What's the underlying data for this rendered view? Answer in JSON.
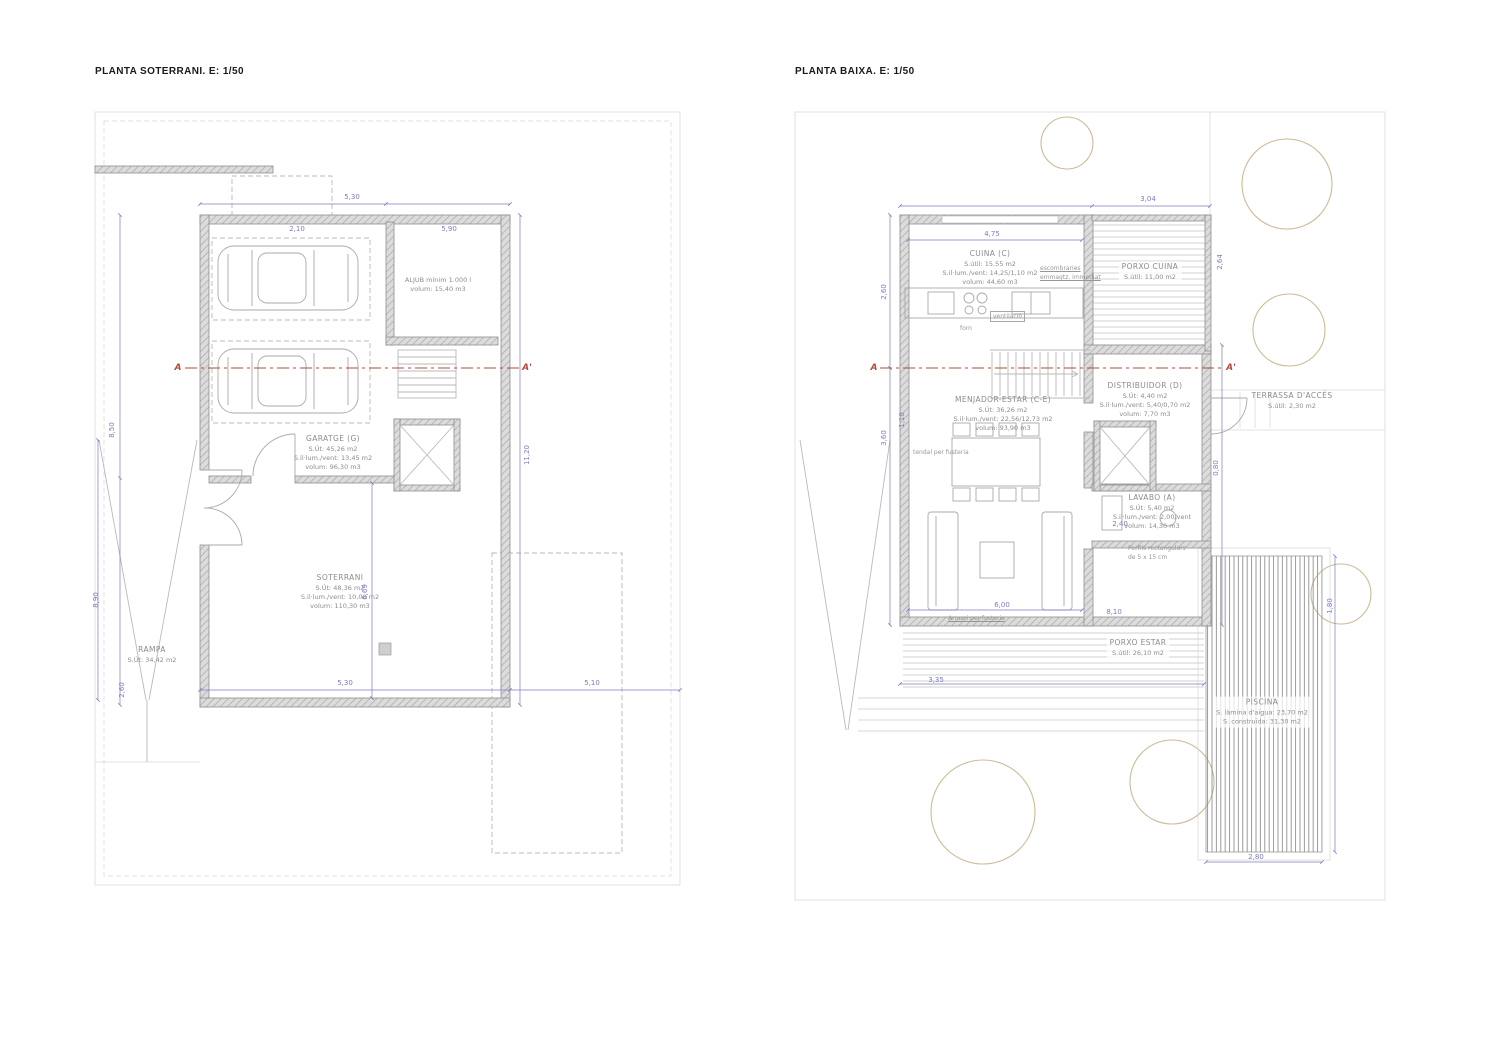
{
  "colors": {
    "paper": "#ffffff",
    "line": "#b9b9b9",
    "line_light": "#d9d9d9",
    "wall_edge": "#8f8f8f",
    "wall_fill": "#dcdcdc",
    "wall_hatch": "#a8a8a8",
    "furniture": "#a9a9a9",
    "dimension": "#7b7bc4",
    "section": "#b5483a",
    "tree": "#cdbb95",
    "label": "#8c8c8c",
    "title": "#1a1a1a"
  },
  "left_plan": {
    "title": "PLANTA SOTERRANI. E: 1/50",
    "section_marks": {
      "start": "A",
      "end": "A'"
    },
    "rooms": {
      "aljub": {
        "lines": [
          "ALJUB mínim 1.000 l",
          "volum: 15,40 m3"
        ]
      },
      "garatge": {
        "lines": [
          "GARATGE (G)",
          "S.Út: 45,26 m2",
          "S.il·lum./vent: 13,45 m2",
          "volum: 96,30 m3"
        ]
      },
      "soterrani": {
        "lines": [
          "SOTERRANI",
          "S.Út: 48,36 m2",
          "S.il·lum./vent: 10,00 m2",
          "volum: 110,30 m3"
        ]
      },
      "rampa": {
        "lines": [
          "RAMPA",
          "S.Út: 34,42 m2"
        ]
      }
    },
    "dims": [
      {
        "t": "5,30",
        "x": 352,
        "y": 197
      },
      {
        "t": "2,10",
        "x": 297,
        "y": 229
      },
      {
        "t": "5,90",
        "x": 449,
        "y": 229
      },
      {
        "t": "8,50",
        "x": 112,
        "y": 430,
        "v": 1
      },
      {
        "t": "8,90",
        "x": 96,
        "y": 600,
        "v": 1
      },
      {
        "t": "11,20",
        "x": 527,
        "y": 455,
        "v": 1
      },
      {
        "t": "6,69",
        "x": 365,
        "y": 592,
        "v": 1
      },
      {
        "t": "2,60",
        "x": 122,
        "y": 690,
        "v": 1
      },
      {
        "t": "5,30",
        "x": 345,
        "y": 683
      },
      {
        "t": "5,10",
        "x": 592,
        "y": 683
      }
    ]
  },
  "right_plan": {
    "title": "PLANTA BAIXA. E: 1/50",
    "section_marks": {
      "start": "A",
      "end": "A'"
    },
    "rooms": {
      "cuina": {
        "lines": [
          "CUINA (C)",
          "S.útil: 15,55 m2",
          "S.il·lum./vent: 14,25/1,10 m2",
          "volum: 44,60 m3"
        ]
      },
      "porxo_cuina": {
        "lines": [
          "PORXO CUINA",
          "S.útil: 11,00 m2"
        ]
      },
      "menjador": {
        "lines": [
          "MENJADOR-ESTAR (C-E)",
          "S.Út: 36,26 m2",
          "S.il·lum./vent: 22,56/12,73 m2",
          "volum: 93,90 m3"
        ]
      },
      "distribuidor": {
        "lines": [
          "DISTRIBUIDOR (D)",
          "S.Út: 4,40 m2",
          "S.il·lum./vent: 5,40/0,70 m2",
          "volum: 7,70 m3"
        ]
      },
      "lavabo": {
        "lines": [
          "LAVABO (A)",
          "S.Út: 5,40 m2",
          "S.il·lum./vent: 2,00/vent",
          "volum: 14,30 m3"
        ]
      },
      "terrassa": {
        "lines": [
          "TERRASSA D'ACCÉS",
          "S.útil: 2,30 m2"
        ]
      },
      "porxo_estar": {
        "lines": [
          "PORXO ESTAR",
          "S.útil: 26,10 m2"
        ]
      },
      "piscina": {
        "lines": [
          "PISCINA",
          "S. làmina d'aigua: 23,70 m2",
          "S. construïda: 31,30 m2"
        ]
      }
    },
    "notes": {
      "escombraries": [
        "escombraries",
        "emmagtz. immediat"
      ],
      "ventilacio": "ventilació",
      "forn": "forn",
      "tendal": "tendal per fusteria",
      "armari": "Armari per fusteria",
      "perfils": [
        "Perfils rectangulars",
        "de 5 x 15 cm"
      ]
    },
    "dims": [
      {
        "t": "3,04",
        "x": 1148,
        "y": 199
      },
      {
        "t": "4,75",
        "x": 992,
        "y": 234
      },
      {
        "t": "2,64",
        "x": 1220,
        "y": 262,
        "v": 1
      },
      {
        "t": "2,60",
        "x": 884,
        "y": 292,
        "v": 1
      },
      {
        "t": "3,60",
        "x": 884,
        "y": 438,
        "v": 1
      },
      {
        "t": "1,10",
        "x": 902,
        "y": 420,
        "v": 1
      },
      {
        "t": "6,00",
        "x": 1002,
        "y": 605
      },
      {
        "t": "8,10",
        "x": 1114,
        "y": 612
      },
      {
        "t": "3,35",
        "x": 936,
        "y": 680
      },
      {
        "t": "2,40",
        "x": 1120,
        "y": 524
      },
      {
        "t": "0,80",
        "x": 1216,
        "y": 468,
        "v": 1
      },
      {
        "t": "1,80",
        "x": 1330,
        "y": 606,
        "v": 1
      },
      {
        "t": "2,80",
        "x": 1256,
        "y": 857
      }
    ]
  }
}
